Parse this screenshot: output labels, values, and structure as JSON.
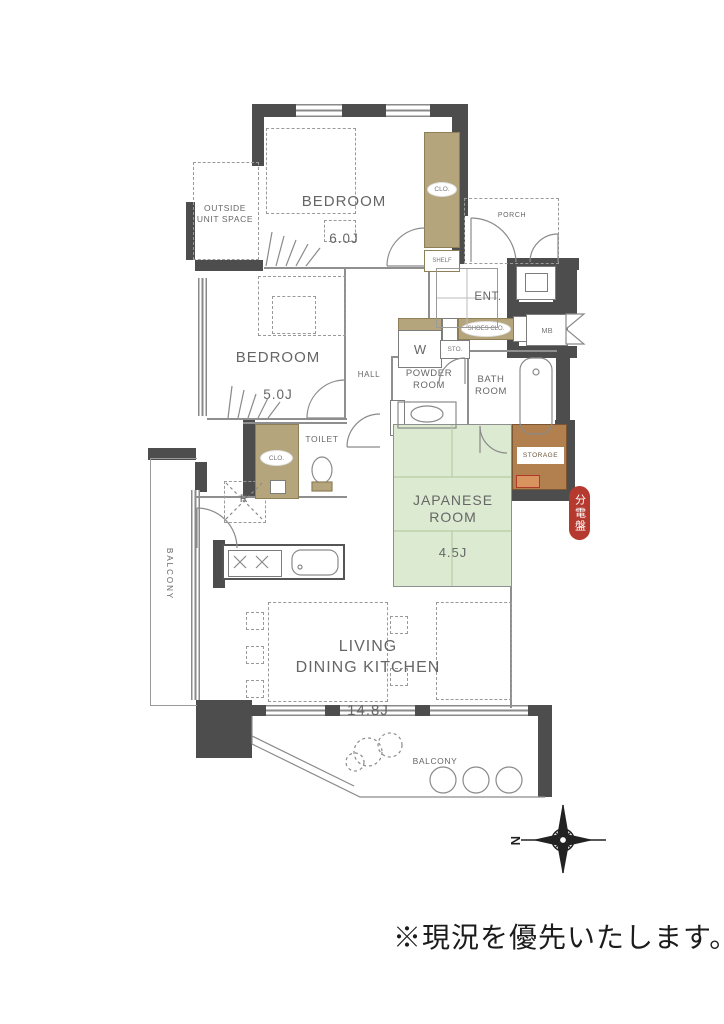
{
  "note": "※現況を優先いたします。",
  "compass": {
    "north": "N"
  },
  "badge": {
    "text": "分電盤"
  },
  "rooms": {
    "bedroom6": {
      "name": "BEDROOM",
      "size": "6.0J"
    },
    "bedroom5": {
      "name": "BEDROOM",
      "size": "5.0J"
    },
    "outside_unit_space": "OUTSIDE\nUNIT SPACE",
    "porch": "PORCH",
    "entrance": "ENT.",
    "hall": "HALL",
    "powder_room": "POWDER\nROOM",
    "bath_room": "BATH\nROOM",
    "toilet": "TOILET",
    "japanese_room": {
      "name": "JAPANESE\nROOM",
      "size": "4.5J"
    },
    "ldk": {
      "name": "LIVING\nDINING KITCHEN",
      "size": "14.8J"
    },
    "storage": "STORAGE",
    "balcony_left": "BALCONY",
    "balcony_bottom": "BALCONY"
  },
  "fixtures": {
    "closet_bedroom6": "CLO.",
    "shelf": "SHELF",
    "closet_hall": "CLO.",
    "shoes_closet": "SHOES CLO.",
    "washer": "W",
    "storage_small": "STO.",
    "meter_box": "MB",
    "refrigerator": "R"
  },
  "colors": {
    "wall": "#4d4d4d",
    "closet_tan": "#b5a57d",
    "tatami_green": "#dcead2",
    "storage_brown": "#b2804f",
    "badge_red": "#b5392e"
  }
}
